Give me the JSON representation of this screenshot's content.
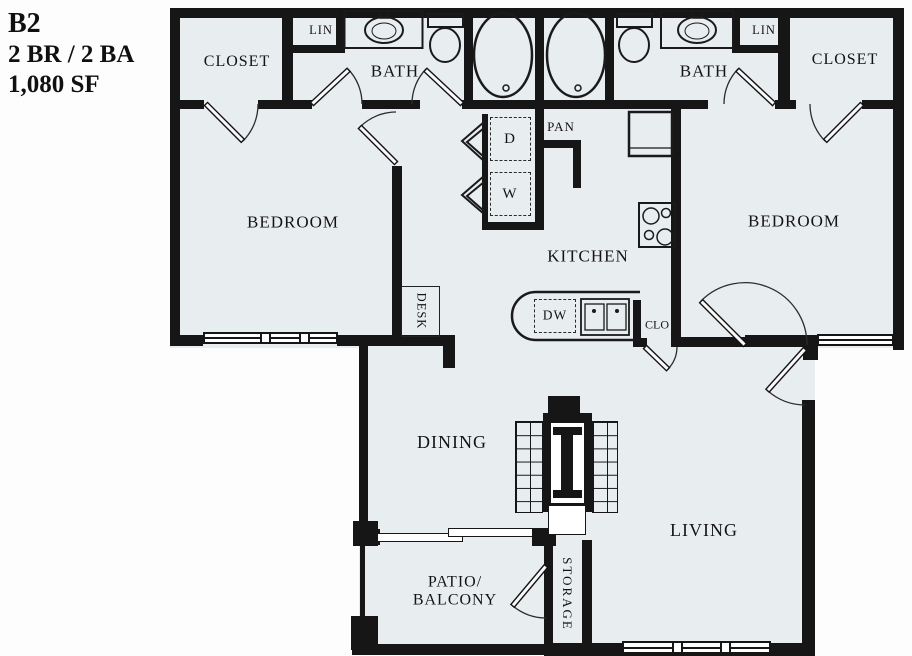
{
  "title": {
    "plan_code": "B2",
    "bed_bath": "2 BR / 2 BA",
    "square_feet": "1,080 SF"
  },
  "rooms": {
    "closet_left": "CLOSET",
    "linen_left": "LIN",
    "bath_left": "BATH",
    "bedroom_left": "BEDROOM",
    "bath_right": "BATH",
    "linen_right": "LIN",
    "closet_right": "CLOSET",
    "bedroom_right": "BEDROOM",
    "kitchen": "KITCHEN",
    "pantry": "PAN",
    "closet_small": "CLO",
    "desk": "DESK",
    "dining": "DINING",
    "living": "LIVING",
    "patio_line1": "PATIO/",
    "patio_line2": "BALCONY",
    "storage": "STORAGE"
  },
  "appliances": {
    "dryer": "D",
    "washer": "W",
    "dishwasher": "DW"
  },
  "colors": {
    "wall": "#161616",
    "floor": "#e8edef",
    "outside": "#fdfdfd",
    "line": "#1a1a1a"
  }
}
